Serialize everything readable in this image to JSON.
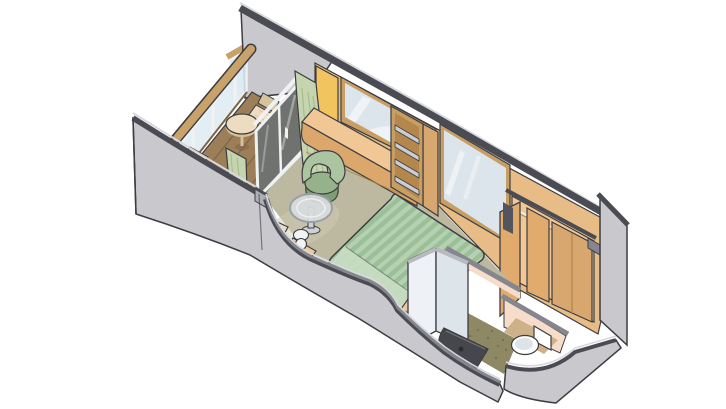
{
  "scene": {
    "kind": "isometric-stateroom-cutaway-floorplan",
    "background": "#ffffff"
  },
  "parts": {
    "balcony": "balcony",
    "railing": "balcony-railing",
    "deck": "balcony-deck",
    "balcony_chairs": "deck-chairs",
    "balcony_table": "balcony-table",
    "sliding_door": "sliding-glass-door",
    "curtains": "curtains",
    "vanity": "vanity-desk-with-mirror",
    "shelf_unit": "shelf-unit",
    "wall_mirror": "wall-mirror",
    "armchair": "armchair",
    "cocktail_table": "glass-cocktail-table",
    "ottoman": "ottoman",
    "bed": "queen-bed-green-striped",
    "nightstands": "nightstands-with-lamps",
    "wardrobe": "wardrobe-closet",
    "bathroom": "bathroom-with-shower-and-toilet",
    "entry": "entry-vestibule",
    "hull_walls": "gray-cutaway-walls"
  },
  "palette": {
    "outline": "#3c3d43",
    "trimDark": "#4b4c53",
    "trimMid": "#85868e",
    "trimLight": "#d7d8dd",
    "wallGray": "#c8c8cd",
    "wallGrayShade": "#aeaeb6",
    "woodWall": "#e7bc86",
    "woodWallDark": "#d8a76f",
    "woodFrame": "#c99e63",
    "woodTrim": "#b08449",
    "yellowPanel": "#f1c45f",
    "mirrorGlass": "#dce5eb",
    "mirrorReflect": "#eef3f6",
    "highlight": "#ffffff",
    "curtain": "#c6d5af",
    "curtainShade": "#a9bd90",
    "doorGlass": "#6f726e",
    "glassPanel": "#dfeaf2",
    "framePost": "#f0f1f3",
    "railCap": "#c9a26a",
    "deck": "#9c7f58",
    "deckLine": "#7d6446",
    "balcFurn": "#eddcc0",
    "balcFurnShade": "#d8c29c",
    "carpet": "#bdb9a0",
    "carpetLight": "#cfcbb2",
    "deskTop": "#f0c795",
    "deskFront": "#dba76a",
    "chair": "#96b28b",
    "chairLight": "#abc5a0",
    "chairShade": "#7ca074",
    "bedLight": "#b6d1b2",
    "bedStripe": "#9bc098",
    "bedFold": "#c8dcc2",
    "lampWhite": "#f2f3f5",
    "tableGlass": "#d8dcdf",
    "tableRim": "#999fa4",
    "tableStem": "#cdd1d4",
    "shelfInner": "#b5874c",
    "shelfSteel": "#caced2",
    "wardrobe": "#e1ab6e",
    "rodSilver": "#e9eaec",
    "darkSlab": "#54555c",
    "showerWall": "#eef1f5",
    "showerWallShade": "#dde4ea",
    "showerInner": "#f6f8fa",
    "showerInner2": "#e8edf2",
    "showerCap": "#b7bac0",
    "showerFloor": "#45474c",
    "drainDark": "#2c2d31",
    "bathFloor": "#8e8864",
    "bathFloorDot": "#6f6a4b",
    "bathWall": "#f6ddca",
    "toilet": "#ffffff",
    "toiletShade": "#dde3e8",
    "vestibuleFloor": "#cdb189"
  }
}
